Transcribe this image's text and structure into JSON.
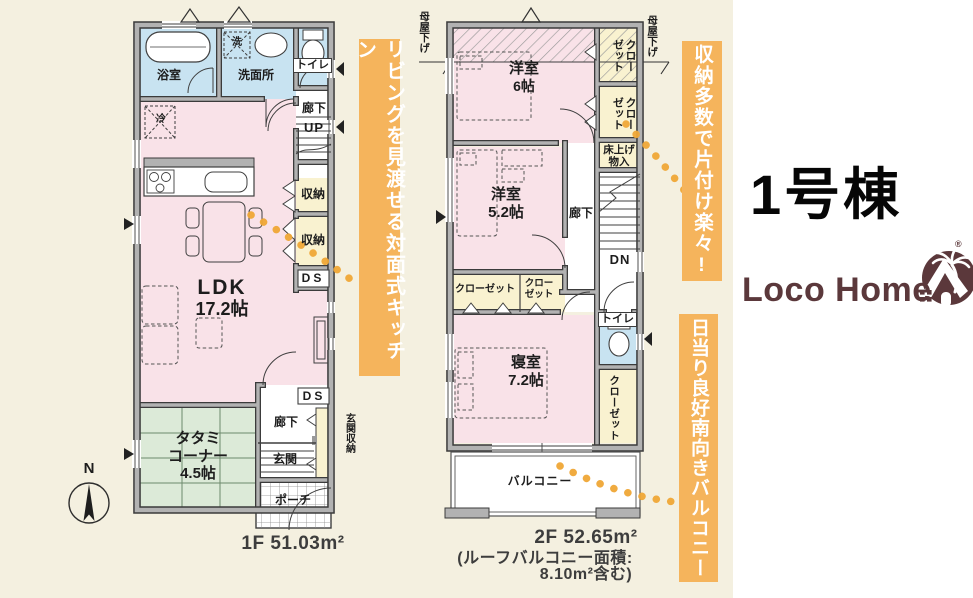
{
  "building": {
    "title": "1号棟"
  },
  "logo": {
    "text": "Loco Home",
    "registered": "®"
  },
  "compass": {
    "north": "N"
  },
  "banners": {
    "kitchen": "リビングを見渡せる対面式キッチン",
    "storage": "収納多数で片付け楽々!",
    "balcony": "日当り良好南向きバルコニー"
  },
  "floor1": {
    "area": "1F 51.03m²",
    "bath": "浴室",
    "washroom": "洗面所",
    "washer": "洗",
    "fridge": "冷",
    "toilet": "トイレ",
    "hallway_upper": "廊下",
    "stairs_up": "UP",
    "storage_a": "収納",
    "storage_b": "収納",
    "duct_upper": "DS",
    "duct_lower": "DS",
    "ldk_name": "LDK",
    "ldk_size": "17.2帖",
    "tatami_line1": "タタミ",
    "tatami_line2": "コーナー",
    "tatami_size": "4.5帖",
    "hallway_lower": "廊下",
    "entrance": "玄関",
    "entrance_storage": "玄関収納",
    "porch": "ポーチ"
  },
  "floor2": {
    "area": "2F 52.65m²",
    "roof_note_line1": "(ルーフバルコニー面積:",
    "roof_note_line2": "8.10m²含む)",
    "eaves_left": "母屋下げ",
    "eaves_right": "母屋下げ",
    "room6_name": "洋室",
    "room6_size": "6帖",
    "room52_name": "洋室",
    "room52_size": "5.2帖",
    "bedroom_name": "寝室",
    "bedroom_size": "7.2帖",
    "closet_top": "クローゼット",
    "closet_mid": "クローゼット",
    "closet_a": "クローゼット",
    "closet_b_line1": "クロー",
    "closet_b_line2": "ゼット",
    "closet_right": "クローゼット",
    "floor_storage_line1": "床上げ",
    "floor_storage_line2": "物入",
    "hallway": "廊下",
    "stairs_dn": "DN",
    "toilet": "トイレ",
    "balcony": "バルコニー"
  },
  "colors": {
    "background": "#f4f0e0",
    "panel": "#ffffff",
    "banner": "#f5b45c",
    "room_pink": "#f9e2e8",
    "room_blue": "#c8e3f1",
    "room_cream": "#f9f2d0",
    "room_green": "#dcead8",
    "dots": "#efa636",
    "logo_brown": "#5b383b"
  }
}
